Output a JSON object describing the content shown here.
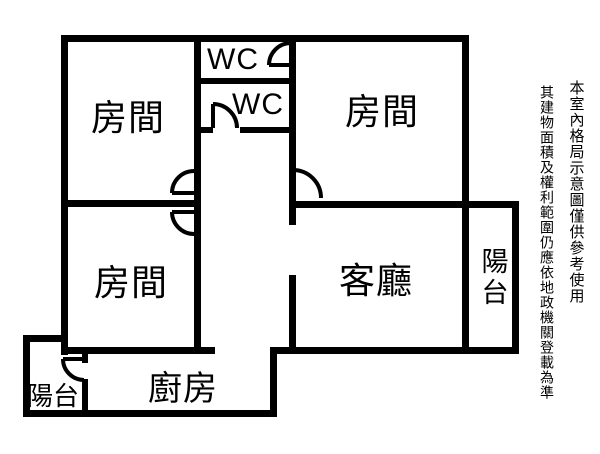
{
  "rooms": {
    "bedroom_top_left": {
      "label": "房間"
    },
    "bedroom_top_right": {
      "label": "房間"
    },
    "bedroom_bottom_left": {
      "label": "房間"
    },
    "wc_top": {
      "label": "WC"
    },
    "wc_bottom": {
      "label": "WC"
    },
    "living_room": {
      "label": "客廳"
    },
    "kitchen": {
      "label": "廚房"
    },
    "balcony_right": {
      "label": "陽台"
    },
    "balcony_bottom_left": {
      "label": "陽台"
    }
  },
  "disclaimer": {
    "line1": "本室內格局示意圖僅供參考使用",
    "line2": "其建物面積及權利範圍仍應依地政機關登載為準"
  },
  "colors": {
    "wall": "#000000",
    "background": "#ffffff",
    "text": "#000000"
  }
}
